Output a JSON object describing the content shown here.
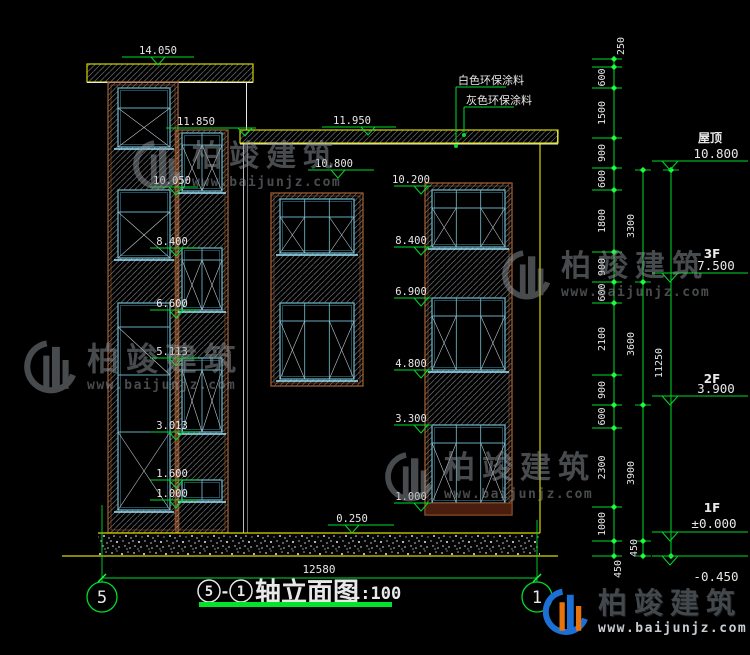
{
  "title": {
    "axis_start": "5",
    "separator": "-",
    "axis_end": "1",
    "name": "轴立面图",
    "scale": "1:100"
  },
  "coatings": [
    "白色环保涂料",
    "灰色环保涂料"
  ],
  "marks_left": [
    "14.050",
    "11.850",
    "10.050",
    "8.400",
    "6.600",
    "5.113",
    "3.013",
    "1.600",
    "1.000"
  ],
  "marks_mid": [
    "11.950",
    "10.800",
    "0.250"
  ],
  "marks_right": [
    "10.200",
    "8.400",
    "6.900",
    "4.800",
    "3.300",
    "1.000"
  ],
  "floors": [
    {
      "name": "屋顶",
      "value": "10.800"
    },
    {
      "name": "3F",
      "value": "7.500"
    },
    {
      "name": "2F",
      "value": "3.900"
    },
    {
      "name": "1F",
      "value": "±0.000"
    },
    {
      "name": "",
      "value": "-0.450"
    }
  ],
  "chain_inner": [
    "250",
    "600",
    "1500",
    "900",
    "600",
    "1800",
    "900",
    "600",
    "2100",
    "900",
    "600",
    "2300",
    "1000",
    "450"
  ],
  "chain_floor": [
    "3300",
    "3600",
    "3900",
    "450"
  ],
  "chain_total": [
    "11250"
  ],
  "total_width": "12580",
  "axes": [
    "5",
    "1"
  ],
  "watermark": {
    "brand": "柏竣建筑",
    "url": "www.baijunjz.com"
  }
}
